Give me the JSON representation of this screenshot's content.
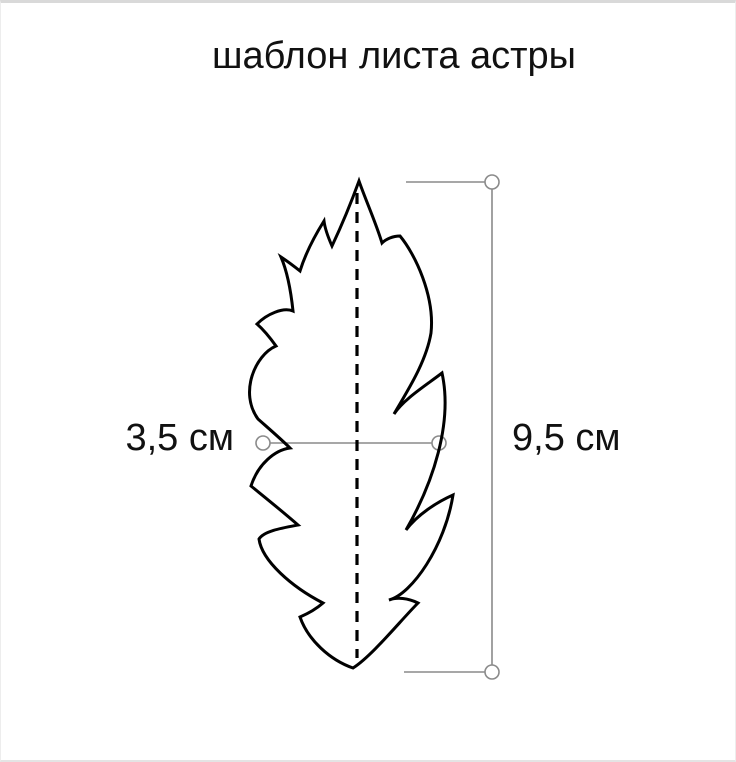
{
  "title": "шаблон листа астры",
  "measurements": {
    "width": {
      "label": "3,5 см",
      "value_cm": 3.5
    },
    "height": {
      "label": "9,5 см",
      "value_cm": 9.5
    }
  },
  "colors": {
    "leaf_outline": "#000000",
    "fold_line": "#000000",
    "measure_line": "#8a8a8a",
    "text": "#111111",
    "background": "#ffffff"
  }
}
